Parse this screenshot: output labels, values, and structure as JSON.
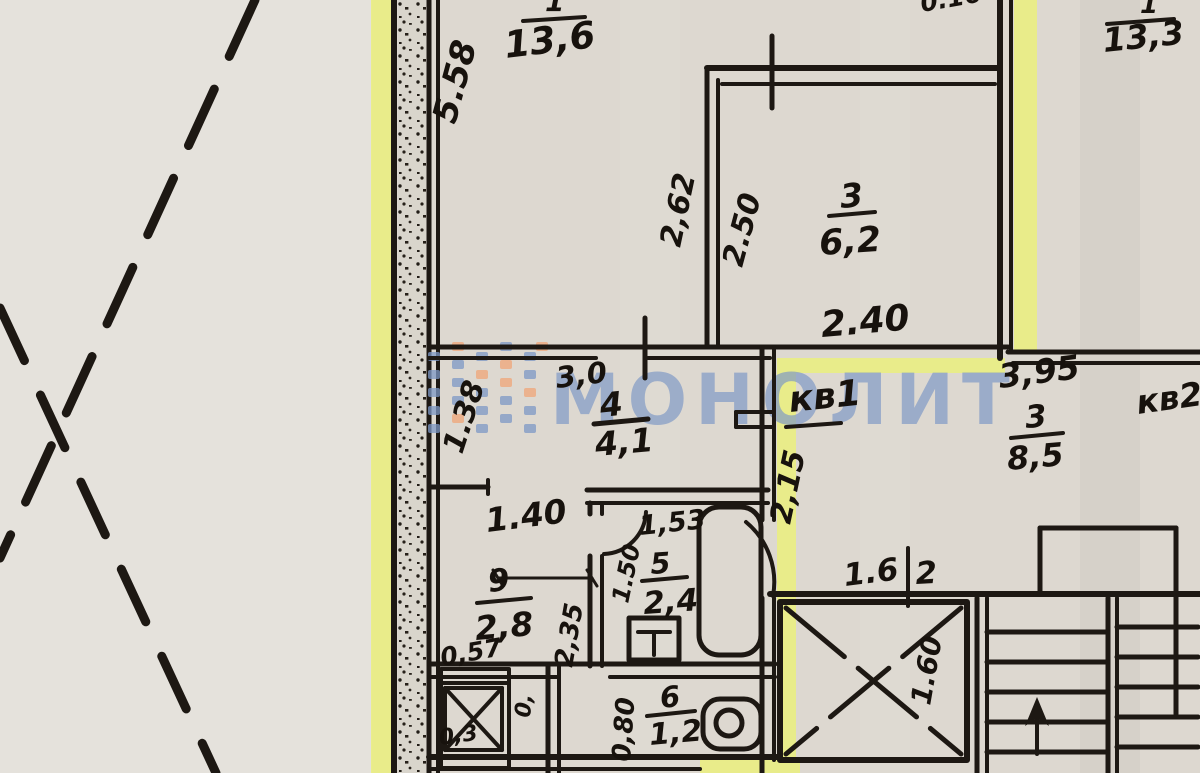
{
  "watermark": {
    "text": "МОНОЛИТ",
    "logo": "monolit-squares-logo",
    "brand_blue": "#7d98c6",
    "brand_orange": "#f0a678"
  },
  "highlight_color": "#ebf07e",
  "apartments": {
    "kv1": "кв1",
    "kv2": "кв2"
  },
  "rooms": {
    "r1a": {
      "num": "1",
      "area": "13,6"
    },
    "r1b": {
      "num": "1",
      "area": "13,3"
    },
    "r3a": {
      "num": "3",
      "area": "6,2"
    },
    "r4": {
      "num": "4",
      "area": "4,1"
    },
    "r3b": {
      "num": "3",
      "area": "8,5"
    },
    "r5": {
      "num": "5",
      "area": "2,4"
    },
    "r9": {
      "num": "9",
      "area": "2,8"
    },
    "r6": {
      "num": "6",
      "area": "1,2"
    }
  },
  "dims": {
    "d558": "5.58",
    "d016": "0.16",
    "d262": "2,62",
    "d250": "2.50",
    "d240": "2.40",
    "d30": "3,0",
    "d138": "1.38",
    "d395": "3,95",
    "d215": "2,15",
    "d140": "1.40",
    "d153": "1,53",
    "d150": "1.50",
    "d235": "2,35",
    "d057": "0,57",
    "d03": "0,3",
    "d0": "0,",
    "d080": "0,80",
    "d16": "1.6",
    "d2": "2",
    "d160": "1.60"
  }
}
